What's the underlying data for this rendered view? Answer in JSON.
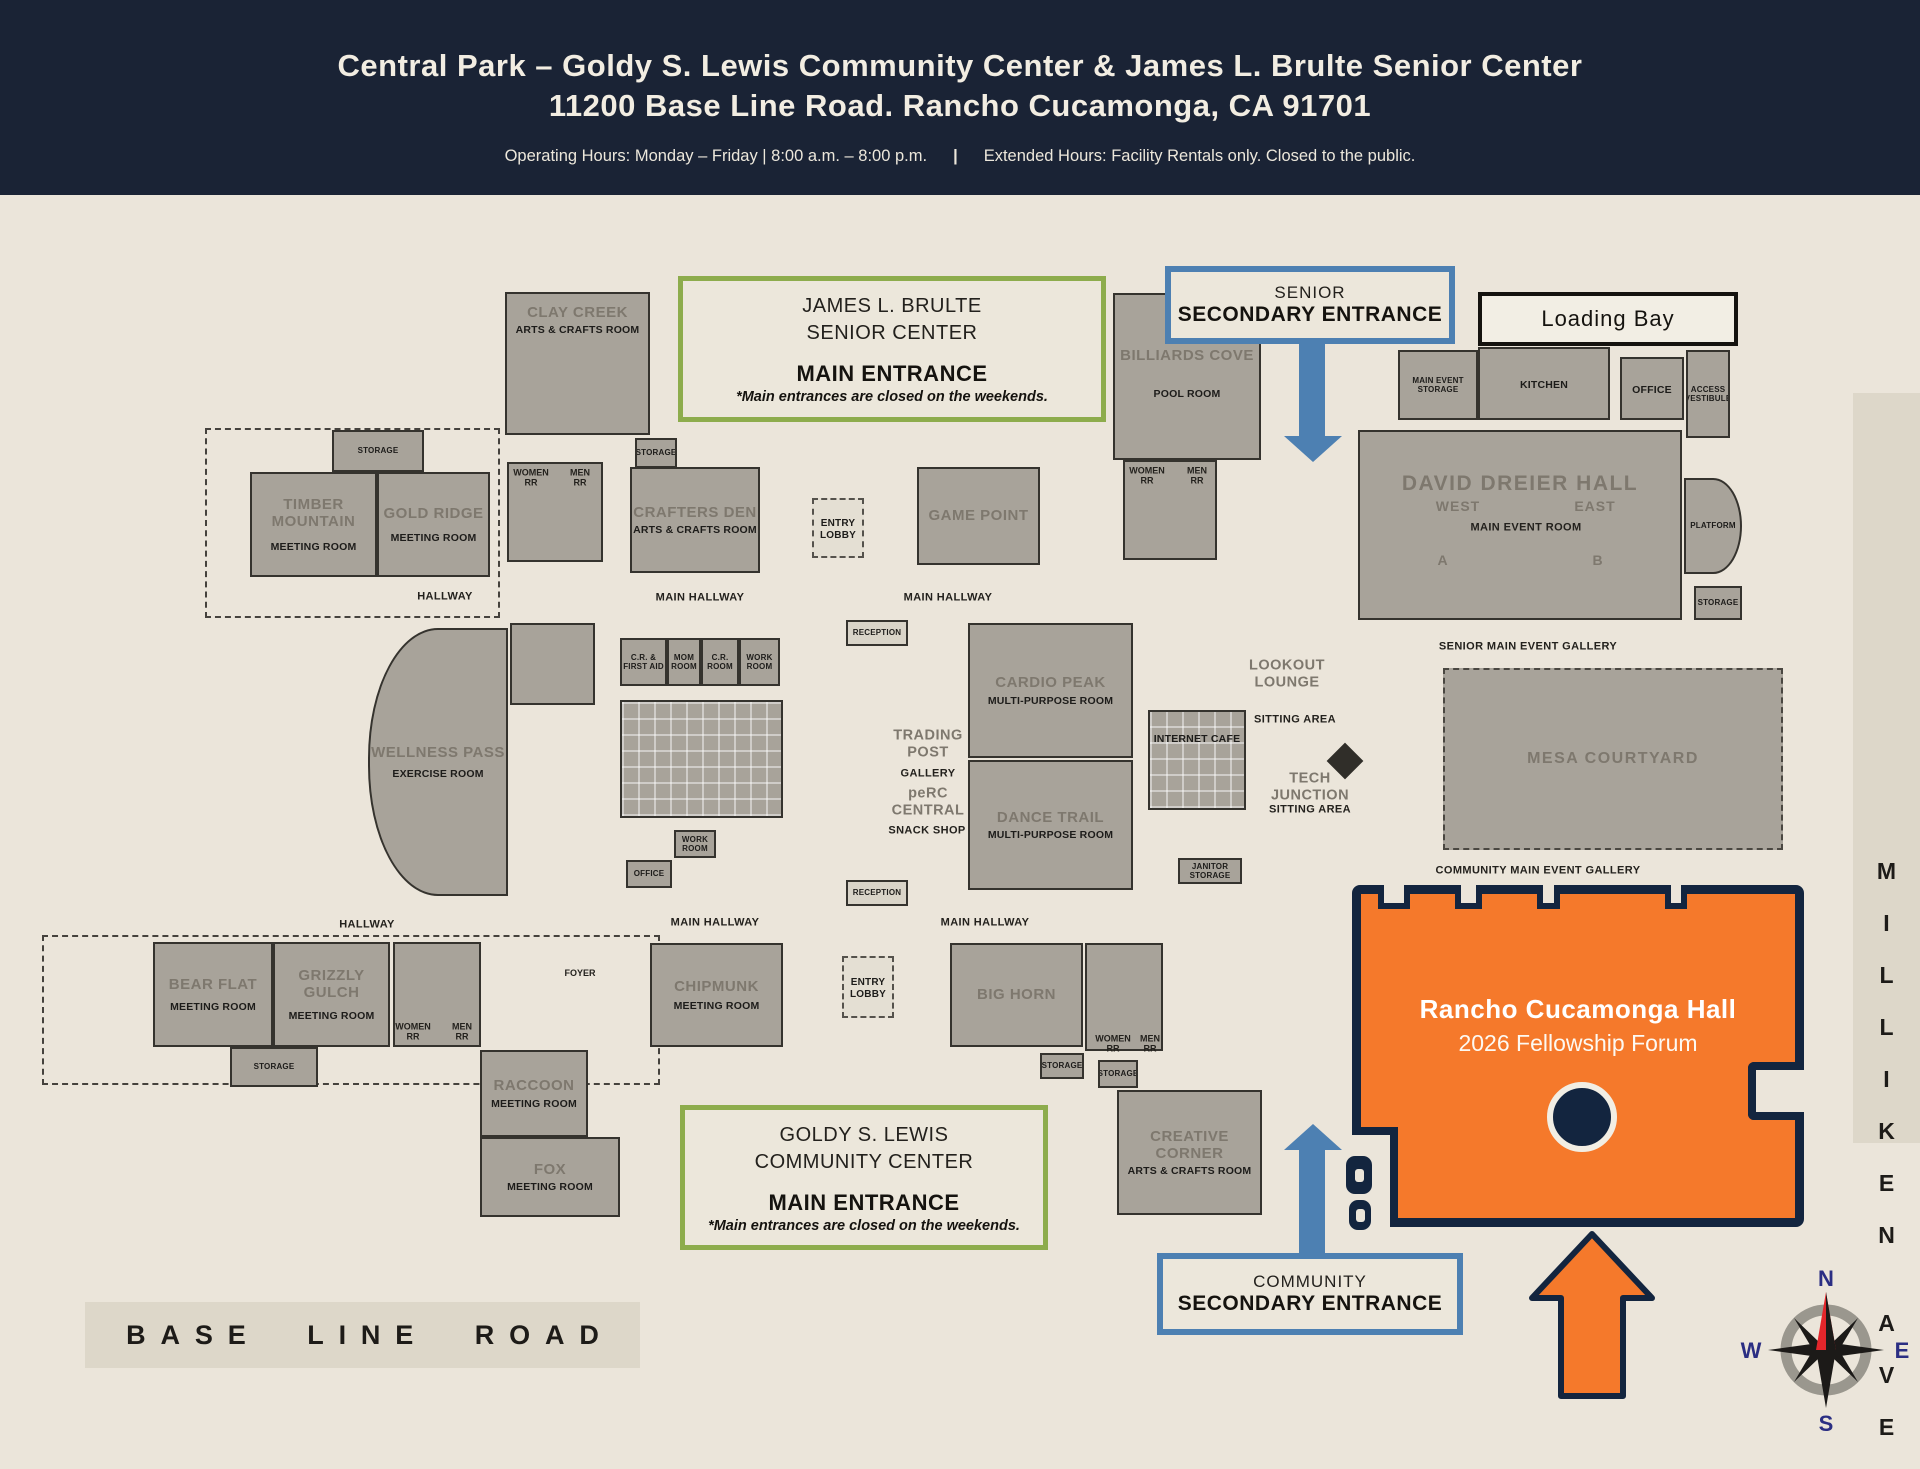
{
  "header": {
    "title_line1": "Central Park – Goldy S. Lewis Community  Center & James L. Brulte Senior Center",
    "title_line2": "11200 Base Line Road.  Rancho Cucamonga, CA 91701",
    "hours_left": "Operating Hours: Monday – Friday | 8:00 a.m. – 8:00 p.m.",
    "hours_divider": "|",
    "hours_right": "Extended Hours: Facility Rentals only. Closed to the public."
  },
  "callouts": {
    "senior_main": {
      "line1": "JAMES L. BRULTE",
      "line2": "SENIOR CENTER",
      "line3": "MAIN ENTRANCE",
      "line4": "*Main entrances are closed on the weekends."
    },
    "senior_secondary": {
      "line1": "SENIOR",
      "line2": "SECONDARY ENTRANCE"
    },
    "community_main": {
      "line1": "GOLDY S. LEWIS",
      "line2": "COMMUNITY CENTER",
      "line3": "MAIN ENTRANCE",
      "line4": "*Main entrances are closed on the weekends."
    },
    "community_secondary": {
      "line1": "COMMUNITY",
      "line2": "SECONDARY ENTRANCE"
    },
    "loading_bay": "Loading Bay"
  },
  "hall": {
    "name": "Rancho Cucamonga Hall",
    "event": "2026 Fellowship Forum"
  },
  "roads": {
    "baseline": "BASE LINE ROAD",
    "milliken": [
      "M",
      "I",
      "L",
      "L",
      "I",
      "K",
      "E",
      "N"
    ],
    "ave": [
      "A",
      "V",
      "E"
    ]
  },
  "compass": {
    "n": "N",
    "s": "S",
    "e": "E",
    "w": "W"
  },
  "colors": {
    "header_navy": "#1a2335",
    "cream": "#ebe5da",
    "room_gray": "#a8a39a",
    "green_accent": "#8dac4c",
    "blue_accent": "#4d80b2",
    "orange_highlight": "#f5792b",
    "hall_outline_navy": "#13253f"
  },
  "plan": {
    "patios": [
      {
        "x": 205,
        "y": 428,
        "w": 295,
        "h": 190
      },
      {
        "x": 42,
        "y": 935,
        "w": 618,
        "h": 150
      }
    ],
    "rooms": [
      {
        "id": "clay-creek",
        "x": 505,
        "y": 292,
        "w": 145,
        "h": 143,
        "name": "CLAY CREEK",
        "sub": "ARTS & CRAFTS ROOM",
        "pt": 10
      },
      {
        "id": "storage-1",
        "x": 332,
        "y": 430,
        "w": 92,
        "h": 42,
        "sub": "STORAGE",
        "cls": "tiny"
      },
      {
        "id": "timber-mountain",
        "x": 250,
        "y": 472,
        "w": 127,
        "h": 105,
        "name": "TIMBER MOUNTAIN",
        "sub": "MEETING ROOM",
        "gap": 10
      },
      {
        "id": "gold-ridge",
        "x": 377,
        "y": 472,
        "w": 113,
        "h": 105,
        "name": "GOLD RIDGE",
        "sub": "MEETING ROOM",
        "gap": 10
      },
      {
        "id": "restrooms-1",
        "x": 507,
        "y": 462,
        "w": 96,
        "h": 100
      },
      {
        "id": "storage-2",
        "x": 635,
        "y": 438,
        "w": 42,
        "h": 30,
        "sub": "STORAGE",
        "cls": "tiny"
      },
      {
        "id": "crafters-den",
        "x": 630,
        "y": 467,
        "w": 130,
        "h": 106,
        "name": "CRAFTERS DEN",
        "sub": "ARTS & CRAFTS ROOM"
      },
      {
        "id": "entry-lobby-north",
        "x": 812,
        "y": 498,
        "w": 52,
        "h": 60,
        "sub": "ENTRY LOBBY",
        "cls": "dashed"
      },
      {
        "id": "game-point",
        "x": 917,
        "y": 467,
        "w": 123,
        "h": 98,
        "name": "GAME POINT"
      },
      {
        "id": "billiards-cove",
        "x": 1113,
        "y": 293,
        "w": 148,
        "h": 167,
        "name": "BILLIARDS COVE",
        "sub": "POOL ROOM",
        "pt": 52,
        "gap": 24
      },
      {
        "id": "restrooms-2",
        "x": 1123,
        "y": 460,
        "w": 94,
        "h": 100
      },
      {
        "id": "storage-main-event",
        "x": 1398,
        "y": 350,
        "w": 80,
        "h": 70,
        "sub": "MAIN EVENT STORAGE",
        "cls": "tiny"
      },
      {
        "id": "kitchen",
        "x": 1478,
        "y": 347,
        "w": 132,
        "h": 73,
        "sub": "KITCHEN"
      },
      {
        "id": "office-1",
        "x": 1620,
        "y": 357,
        "w": 64,
        "h": 63,
        "sub": "OFFICE"
      },
      {
        "id": "access-vestibule",
        "x": 1686,
        "y": 350,
        "w": 44,
        "h": 88,
        "sub": "ACCESS VESTIBULE",
        "cls": "tiny"
      },
      {
        "id": "david-dreier-hall",
        "x": 1358,
        "y": 430,
        "w": 324,
        "h": 190,
        "name": "DAVID DREIER HALL",
        "cls": "big",
        "pt": 40
      },
      {
        "id": "platform",
        "x": 1684,
        "y": 478,
        "w": 58,
        "h": 96,
        "sub": "PLATFORM",
        "cls": "tiny platform"
      },
      {
        "id": "storage-3",
        "x": 1694,
        "y": 586,
        "w": 48,
        "h": 34,
        "sub": "STORAGE",
        "cls": "tiny"
      },
      {
        "id": "wellness-pass",
        "x": 368,
        "y": 628,
        "w": 140,
        "h": 268,
        "name": "WELLNESS PASS",
        "sub": "EXERCISE ROOM",
        "cls": "curved",
        "gap": 6
      },
      {
        "id": "sitting-room",
        "x": 510,
        "y": 623,
        "w": 85,
        "h": 82
      },
      {
        "id": "cr-first-aid",
        "x": 620,
        "y": 638,
        "w": 47,
        "h": 48,
        "sub": "C.R. & FIRST AID",
        "cls": "tiny"
      },
      {
        "id": "mom-room",
        "x": 667,
        "y": 638,
        "w": 34,
        "h": 48,
        "sub": "MOM ROOM",
        "cls": "tiny"
      },
      {
        "id": "cr-room",
        "x": 701,
        "y": 638,
        "w": 38,
        "h": 48,
        "sub": "C.R. ROOM",
        "cls": "tiny"
      },
      {
        "id": "work-room-1",
        "x": 739,
        "y": 638,
        "w": 41,
        "h": 48,
        "sub": "WORK ROOM",
        "cls": "tiny"
      },
      {
        "id": "cubicle-area",
        "x": 620,
        "y": 700,
        "w": 163,
        "h": 118,
        "cls": "grid"
      },
      {
        "id": "work-room-2",
        "x": 674,
        "y": 830,
        "w": 42,
        "h": 28,
        "sub": "WORK ROOM",
        "cls": "tiny"
      },
      {
        "id": "office-2",
        "x": 626,
        "y": 860,
        "w": 46,
        "h": 28,
        "sub": "OFFICE",
        "cls": "tiny"
      },
      {
        "id": "reception-1",
        "x": 846,
        "y": 620,
        "w": 62,
        "h": 26,
        "sub": "RECEPTION",
        "cls": "tiny light"
      },
      {
        "id": "cardio-peak",
        "x": 968,
        "y": 623,
        "w": 165,
        "h": 135,
        "name": "CARDIO PEAK",
        "sub": "MULTI-PURPOSE ROOM"
      },
      {
        "id": "dance-trail",
        "x": 968,
        "y": 760,
        "w": 165,
        "h": 130,
        "name": "DANCE TRAIL",
        "sub": "MULTI-PURPOSE ROOM"
      },
      {
        "id": "internet-cafe",
        "x": 1148,
        "y": 710,
        "w": 98,
        "h": 100,
        "sub": "INTERNET CAFE",
        "cls": "grid",
        "pt": 18
      },
      {
        "id": "janitor-storage",
        "x": 1178,
        "y": 858,
        "w": 64,
        "h": 26,
        "sub": "JANITOR STORAGE",
        "cls": "tiny"
      },
      {
        "id": "reception-2",
        "x": 846,
        "y": 880,
        "w": 62,
        "h": 26,
        "sub": "RECEPTION",
        "cls": "tiny light"
      },
      {
        "id": "mesa-courtyard",
        "x": 1443,
        "y": 668,
        "w": 340,
        "h": 182,
        "name": "MESA COURTYARD",
        "cls": "dashedroom"
      },
      {
        "id": "bear-flat",
        "x": 153,
        "y": 942,
        "w": 120,
        "h": 105,
        "name": "BEAR FLAT",
        "sub": "MEETING ROOM",
        "gap": 8
      },
      {
        "id": "grizzly-gulch",
        "x": 273,
        "y": 942,
        "w": 117,
        "h": 105,
        "name": "GRIZZLY GULCH",
        "sub": "MEETING ROOM",
        "gap": 8
      },
      {
        "id": "storage-4",
        "x": 230,
        "y": 1047,
        "w": 88,
        "h": 40,
        "sub": "STORAGE",
        "cls": "tiny"
      },
      {
        "id": "restrooms-3",
        "x": 393,
        "y": 942,
        "w": 88,
        "h": 105
      },
      {
        "id": "raccoon",
        "x": 480,
        "y": 1050,
        "w": 108,
        "h": 87,
        "name": "RACCOON",
        "sub": "MEETING ROOM",
        "gap": 4
      },
      {
        "id": "fox",
        "x": 480,
        "y": 1137,
        "w": 140,
        "h": 80,
        "name": "FOX",
        "sub": "MEETING ROOM",
        "gap": 2
      },
      {
        "id": "chipmunk",
        "x": 650,
        "y": 943,
        "w": 133,
        "h": 104,
        "name": "CHIPMUNK",
        "sub": "MEETING ROOM",
        "gap": 4
      },
      {
        "id": "entry-lobby-south",
        "x": 842,
        "y": 956,
        "w": 52,
        "h": 62,
        "sub": "ENTRY LOBBY",
        "cls": "dashed"
      },
      {
        "id": "big-horn",
        "x": 950,
        "y": 943,
        "w": 133,
        "h": 104,
        "name": "BIG HORN"
      },
      {
        "id": "storage-5",
        "x": 1040,
        "y": 1053,
        "w": 44,
        "h": 26,
        "sub": "STORAGE",
        "cls": "tiny"
      },
      {
        "id": "storage-6",
        "x": 1098,
        "y": 1060,
        "w": 40,
        "h": 28,
        "sub": "STORAGE",
        "cls": "tiny"
      },
      {
        "id": "restrooms-4",
        "x": 1085,
        "y": 943,
        "w": 78,
        "h": 108
      },
      {
        "id": "creative-corner",
        "x": 1117,
        "y": 1090,
        "w": 145,
        "h": 125,
        "name": "CREATIVE CORNER",
        "sub": "ARTS & CRAFTS ROOM",
        "gap": 2
      }
    ],
    "labels": [
      {
        "t": "HALLWAY",
        "x": 445,
        "y": 597,
        "c": "b"
      },
      {
        "t": "MAIN HALLWAY",
        "x": 700,
        "y": 598,
        "c": "b"
      },
      {
        "t": "MAIN HALLWAY",
        "x": 948,
        "y": 598,
        "c": "b"
      },
      {
        "t": "HALLWAY",
        "x": 367,
        "y": 925,
        "c": "b"
      },
      {
        "t": "MAIN HALLWAY",
        "x": 715,
        "y": 923,
        "c": "b"
      },
      {
        "t": "MAIN HALLWAY",
        "x": 985,
        "y": 923,
        "c": "b"
      },
      {
        "t": "SENIOR MAIN EVENT GALLERY",
        "x": 1528,
        "y": 647,
        "c": "b"
      },
      {
        "t": "COMMUNITY MAIN EVENT GALLERY",
        "x": 1538,
        "y": 871,
        "c": "b"
      },
      {
        "t": "WEST",
        "x": 1458,
        "y": 506,
        "c": "g2"
      },
      {
        "t": "EAST",
        "x": 1595,
        "y": 506,
        "c": "g2"
      },
      {
        "t": "MAIN EVENT ROOM",
        "x": 1526,
        "y": 528,
        "c": "b"
      },
      {
        "t": "A",
        "x": 1443,
        "y": 560,
        "c": "g2"
      },
      {
        "t": "B",
        "x": 1598,
        "y": 560,
        "c": "g2"
      },
      {
        "t": "WOMEN RR",
        "x": 531,
        "y": 478,
        "c": "b2",
        "w": 46
      },
      {
        "t": "MEN RR",
        "x": 580,
        "y": 478,
        "c": "b2",
        "w": 34
      },
      {
        "t": "WOMEN RR",
        "x": 1147,
        "y": 476,
        "c": "b2",
        "w": 46
      },
      {
        "t": "MEN RR",
        "x": 1197,
        "y": 476,
        "c": "b2",
        "w": 34
      },
      {
        "t": "WOMEN RR",
        "x": 413,
        "y": 1032,
        "c": "b2",
        "w": 46
      },
      {
        "t": "MEN RR",
        "x": 462,
        "y": 1032,
        "c": "b2",
        "w": 34
      },
      {
        "t": "WOMEN RR",
        "x": 1113,
        "y": 1044,
        "c": "b2",
        "w": 46
      },
      {
        "t": "MEN RR",
        "x": 1150,
        "y": 1044,
        "c": "b2",
        "w": 34
      },
      {
        "t": "FOYER",
        "x": 580,
        "y": 973,
        "c": "b2"
      },
      {
        "t": "TRADING POST",
        "x": 928,
        "y": 744,
        "c": "g",
        "w": 95
      },
      {
        "t": "GALLERY",
        "x": 928,
        "y": 774,
        "c": "b"
      },
      {
        "t": "peRC CENTRAL",
        "x": 928,
        "y": 802,
        "c": "g",
        "w": 95
      },
      {
        "t": "SNACK SHOP",
        "x": 927,
        "y": 831,
        "c": "b"
      },
      {
        "t": "LOOKOUT LOUNGE",
        "x": 1287,
        "y": 674,
        "c": "g",
        "w": 105
      },
      {
        "t": "SITTING AREA",
        "x": 1295,
        "y": 720,
        "c": "b"
      },
      {
        "t": "TECH JUNCTION",
        "x": 1310,
        "y": 787,
        "c": "g",
        "w": 105
      },
      {
        "t": "SITTING AREA",
        "x": 1310,
        "y": 810,
        "c": "b"
      }
    ]
  }
}
